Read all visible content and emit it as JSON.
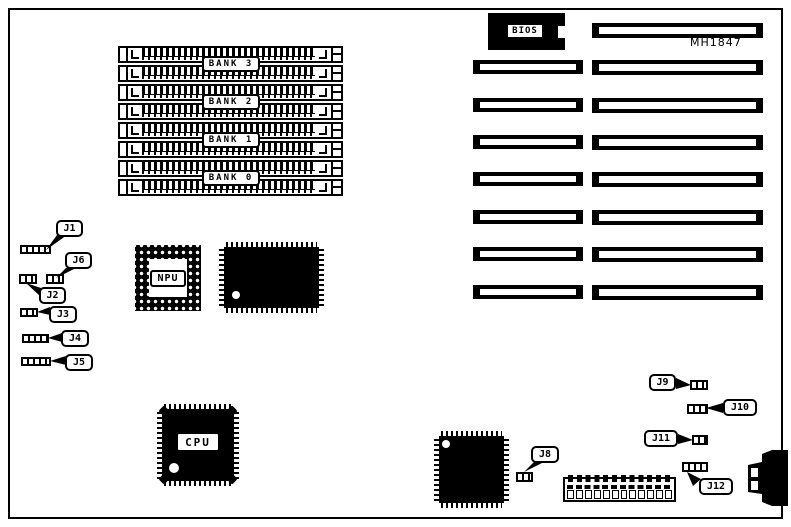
{
  "board": {
    "model_label": "MH1847",
    "memory_banks": [
      {
        "label": "BANK 3"
      },
      {
        "label": "BANK 2"
      },
      {
        "label": "BANK 1"
      },
      {
        "label": "BANK 0"
      }
    ],
    "memory_socket_count": 8,
    "chips": {
      "bios": {
        "label": "BIOS"
      },
      "npu": {
        "label": "NPU"
      },
      "cpu": {
        "label": "CPU"
      }
    },
    "jumpers": {
      "J1": {
        "label": "J1",
        "pins": 5
      },
      "J2": {
        "label": "J2",
        "pins": 3
      },
      "J3": {
        "label": "J3",
        "pins": 3
      },
      "J4": {
        "label": "J4",
        "pins": 4
      },
      "J5": {
        "label": "J5",
        "pins": 5
      },
      "J6": {
        "label": "J6",
        "pins": 3
      },
      "J8": {
        "label": "J8",
        "pins": 3
      },
      "J9": {
        "label": "J9",
        "pins": 2
      },
      "J10": {
        "label": "J10",
        "pins": 3
      },
      "J11": {
        "label": "J11",
        "pins": 2
      },
      "J12": {
        "label": "J12",
        "pins": 4
      }
    },
    "expansion_slots": {
      "left_column_count": 7,
      "right_column_count": 8
    },
    "power_connector_cells": 12,
    "colors": {
      "ink": "#000000",
      "background": "#ffffff"
    }
  }
}
